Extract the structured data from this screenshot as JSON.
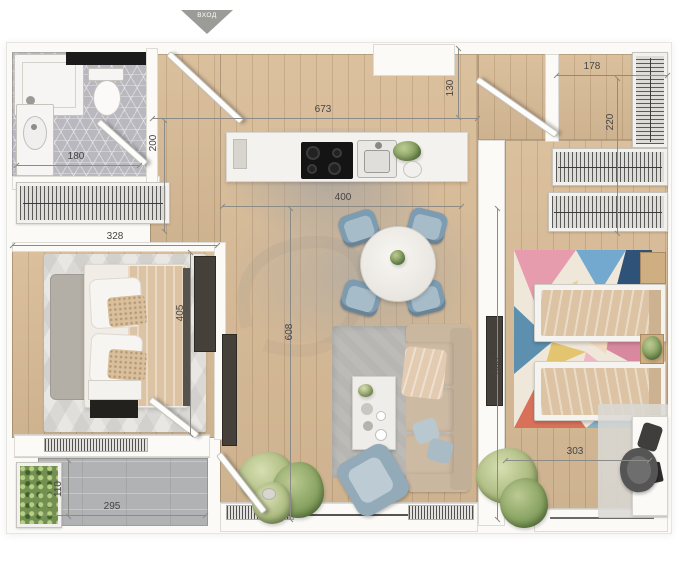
{
  "entrance_marker": {
    "label": "ВХОД"
  },
  "dimensions": {
    "d673": "673",
    "d130": "130",
    "d178": "178",
    "d220": "220",
    "d200": "200",
    "d180": "180",
    "d328": "328",
    "d400": "400",
    "d405": "405",
    "d608_left": "608",
    "d608_right": "608",
    "d110": "110",
    "d295": "295",
    "d303": "303"
  },
  "colors": {
    "wall": "#fbfaf7",
    "wood": "#d9bc97",
    "tile": "#b8b8be",
    "balcony": "#b0b2b3",
    "dim": "#8d8b86",
    "dim_text": "#454545",
    "counter": "#f3f2ef",
    "chair_blue": "#7d9cb1",
    "armchair": "#93aab9",
    "sofa": "#cdbaa3",
    "duvet": "#dcc3a4",
    "dark_panel": "#46403a",
    "rug_living": "#b8b6b2",
    "rug_bedroom": "#e9e7e3",
    "triangle": "#9b9b98"
  }
}
